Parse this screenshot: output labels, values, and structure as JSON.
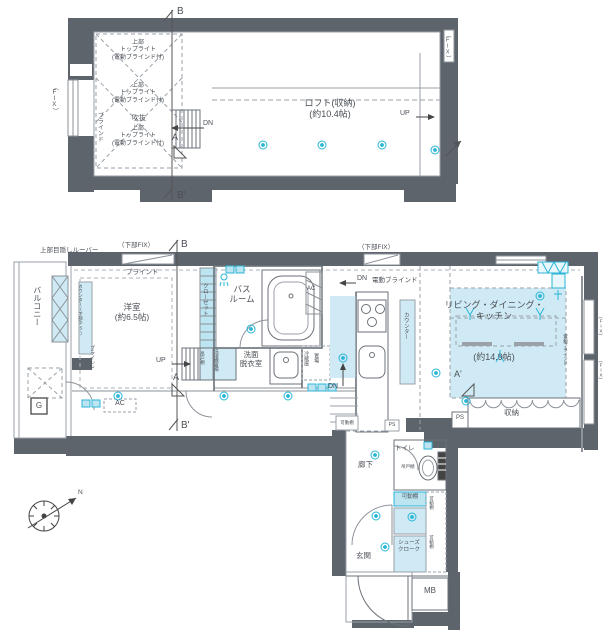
{
  "colors": {
    "wall": "#5d646c",
    "line": "#8d939a",
    "blue_fill": "#cfeaf4",
    "blue_fill2": "#bde5f1",
    "cyan": "#2ab5d6",
    "text": "#4b5057"
  },
  "upper_plan": {
    "section_b": "B",
    "section_b_prime": "B'",
    "section_a": "A",
    "fix_left": "（FIX）",
    "fix_right": "（FIX）",
    "blind": "ブラインド",
    "toplights": [
      "上部\nトップライト\n(電動ブラインド付)",
      "上部\nトップライト\n(電動ブラインド付)",
      "上部\nトップライト\n(電動ブラインド付)"
    ],
    "void_label": "吹抜",
    "dn": "DN",
    "up": "UP",
    "loft_label": "ロフト(収納)\n(約10.4帖)"
  },
  "lower_plan": {
    "section_b": "B",
    "section_b_prime": "B'",
    "section_a": "A",
    "section_a_prime": "A'",
    "louver_label": "上部目隠しルーバー",
    "lower_fix_left": "（下部FIX）",
    "lower_fix_right": "（下部FIX）",
    "blind_window": "ブラインド",
    "power_blind_window": "電動ブラインド",
    "balcony": "バルコニー",
    "gas_box": "G",
    "western_room": "洋室\n(約6.5帖)",
    "counter_ps": "カウンター(下部PS)",
    "blind_side": "ブラインド",
    "closet": "クローゼット",
    "hanging_shelf": "吊戸棚",
    "washer_space": "洗濯機置場",
    "bathroom": "バス\nルーム",
    "washroom": "洗面\n脱衣室",
    "ac_room": "AC",
    "ac_wall": "AC",
    "fridge_line1": "冷蔵庫",
    "fridge_line2": "置場",
    "up": "UP",
    "dn_top": "DN",
    "dn_mid": "DN",
    "counter_kitchen": "カウンター",
    "ldk_name": "リビング・ダイニング・\nキッチン",
    "ldk_size": "(約14.9帖)",
    "storage": "収納",
    "ps_storage": "PS",
    "ps_hall": "PS",
    "power_blind_right": "電動ブラインド",
    "fix_right_1": "（FIX）",
    "fix_right_2": "（FIX）",
    "corridor": "廊下",
    "toilet": "トイレ",
    "toilet_shelf": "吊戸棚",
    "movable_shelves": [
      "可動棚",
      "可動棚",
      "可動棚",
      "可動棚"
    ],
    "shoes_closet": "シューズ\nクローク",
    "entrance": "玄関",
    "meter_box": "MB",
    "north": "N"
  }
}
